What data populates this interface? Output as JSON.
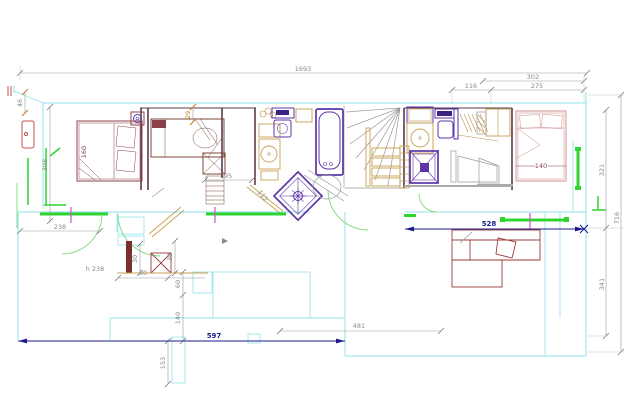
{
  "title": "apartment-floor-plan",
  "dims": {
    "overall": "1693",
    "right_top": "302",
    "right_seg_a": "116",
    "right_seg_b": "275",
    "side_upper": "321",
    "side_total": "716",
    "side_lower": "341",
    "left_small": "46",
    "left_height": "308",
    "annex_width": "238",
    "corridor": "95",
    "gap": "29",
    "door_diagonal": "112",
    "bed_left": "160",
    "bed_right": "140",
    "window_bold": "528",
    "bottom_bold": "597",
    "living": "481",
    "pillar": "153",
    "height_note": "h 238",
    "niche_width": "50",
    "niche_depth_a": "30",
    "niche_depth_b": "30",
    "step_a": "60",
    "step_b": "140"
  },
  "colors": {
    "walls": "#8fe3ea",
    "windows": "#2fd42f",
    "sanitary": "#5b35a8",
    "furniture": "#8b4049",
    "bold_dims": "#1a1a8c",
    "dims": "#9a9a9a",
    "accent_orange": "#c87820",
    "tick_magenta": "#cc55cc"
  }
}
